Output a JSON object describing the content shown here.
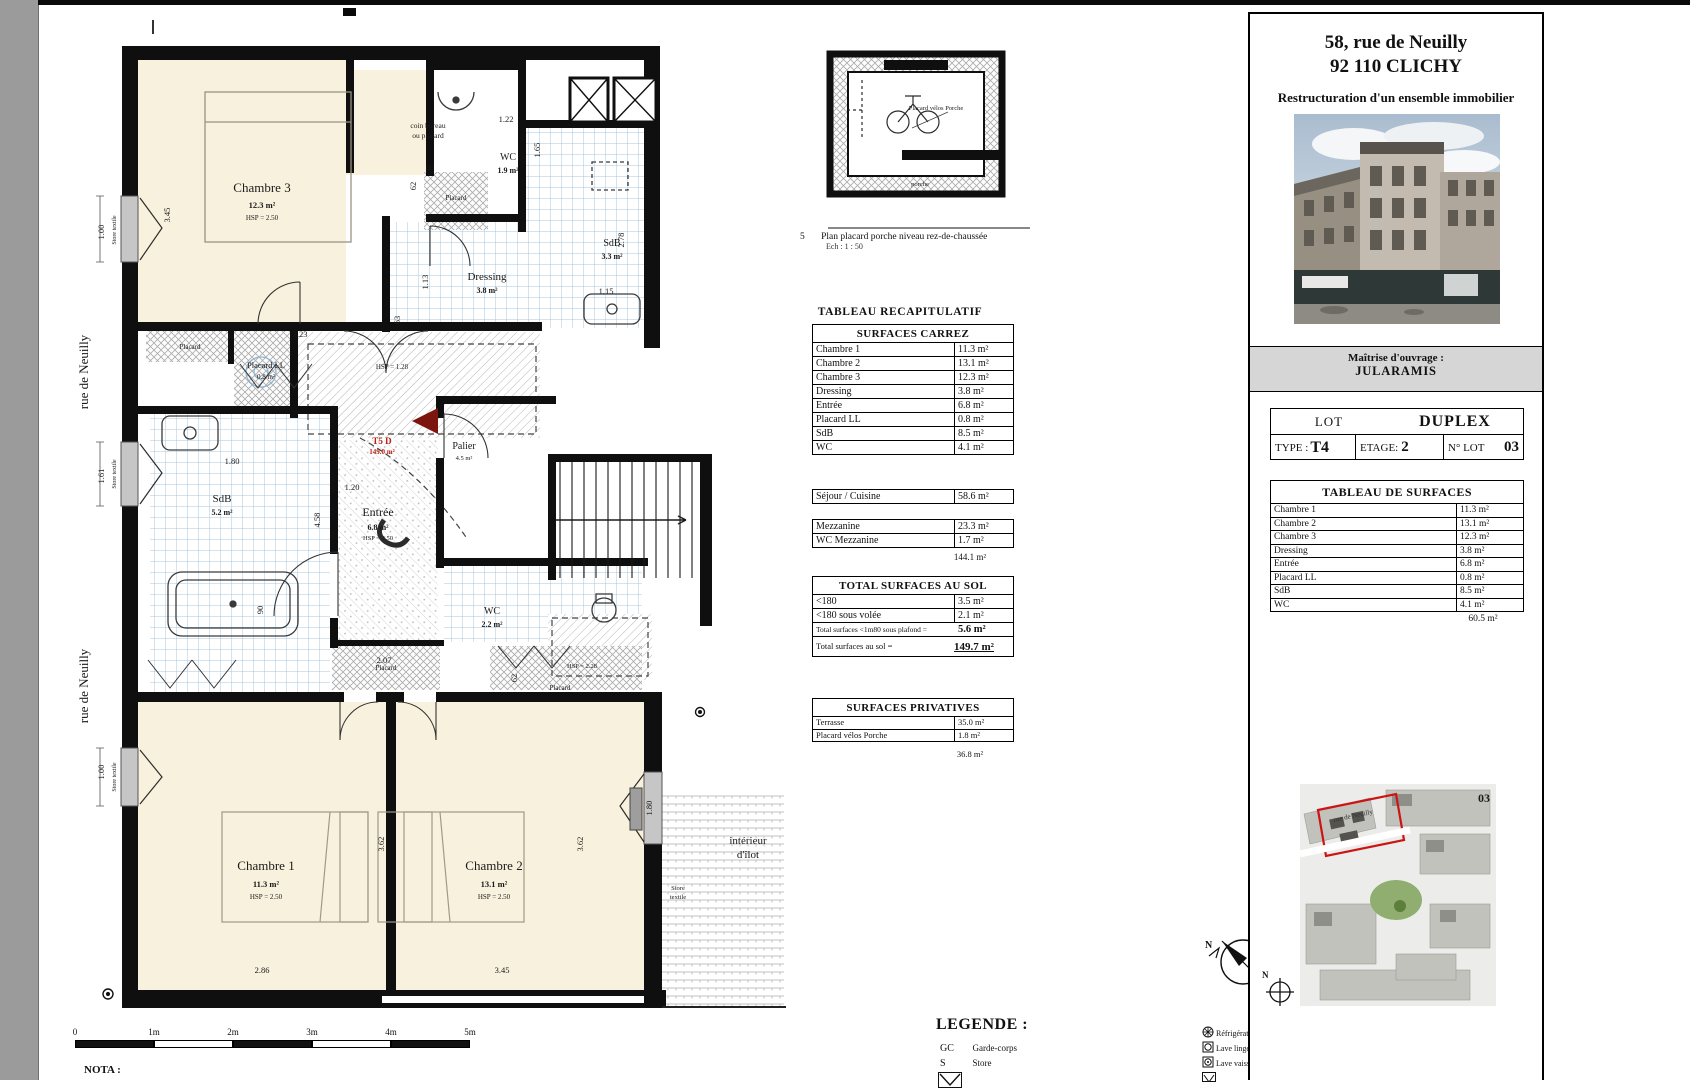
{
  "sheet": {
    "nota": "NOTA :"
  },
  "streets": {
    "rue": "rue de Neuilly"
  },
  "scalebar": {
    "labels": [
      "0",
      "1m",
      "2m",
      "3m",
      "4m",
      "5m"
    ]
  },
  "plan": {
    "chambre3": {
      "name": "Chambre 3",
      "area": "12.3 m²",
      "hsp": "HSP = 2.50"
    },
    "coin1": "coin bureau",
    "coin2": "ou placard",
    "wc_top": {
      "name": "WC",
      "area": "1.9 m²"
    },
    "sdb_top": {
      "name": "SdB",
      "area": "3.3 m²"
    },
    "dressing": {
      "name": "Dressing",
      "area": "3.8 m²"
    },
    "placard": "Placard",
    "placard_ll": {
      "name": "Placard LL",
      "area": "0.8 m²"
    },
    "hsp_128": "HSP = 1.28",
    "hsp_228": "HSP = 2.28",
    "lot_flag": {
      "name": "T5 D",
      "area": "149.0 m²"
    },
    "palier": {
      "name": "Palier",
      "area": "4.5 m²"
    },
    "entree": {
      "name": "Entrée",
      "area": "6.8 m²",
      "hsp": "HSP = 2.50"
    },
    "sdb_main": {
      "name": "SdB",
      "area": "5.2 m²"
    },
    "wc_mid": {
      "name": "WC",
      "area": "2.2 m²"
    },
    "chambre1": {
      "name": "Chambre 1",
      "area": "11.3 m²",
      "hsp": "HSP = 2.50"
    },
    "chambre2": {
      "name": "Chambre 2",
      "area": "13.1 m²",
      "hsp": "HSP = 2.50"
    },
    "interieur1": "intérieur",
    "interieur2": "d'îlot",
    "store": "Store textile",
    "store1": "Store",
    "store2": "textile",
    "dims": {
      "v345": "3.45",
      "h323": "3.23",
      "h60": "60",
      "h122": "1.22",
      "v165": "1.65",
      "v278": "2.78",
      "v113": "1.13",
      "h115": "1.15",
      "v62": "62",
      "v63": "63",
      "h180": "1.80",
      "h120": "1.20",
      "v458": "4.58",
      "v90": "90",
      "h207": "2.07",
      "v362": "3.62",
      "v180": "1.80",
      "h286": "2.86",
      "h345": "3.45",
      "v100": "1.00",
      "v161": "1.61"
    }
  },
  "small_plan": {
    "num": "5",
    "caption": "Plan placard porche niveau rez-de-chaussée",
    "scale": "Ech : 1 : 50",
    "label": "Placard vélos Porche",
    "porche": "porche"
  },
  "recap": {
    "title": "TABLEAU RECAPITULATIF",
    "carrez_title": "SURFACES CARREZ",
    "carrez_rows": [
      {
        "label": "Chambre 1",
        "value": "11.3 m²"
      },
      {
        "label": "Chambre 2",
        "value": "13.1 m²"
      },
      {
        "label": "Chambre 3",
        "value": "12.3 m²"
      },
      {
        "label": "Dressing",
        "value": "3.8 m²"
      },
      {
        "label": "Entrée",
        "value": "6.8 m²"
      },
      {
        "label": "Placard LL",
        "value": "0.8 m²"
      },
      {
        "label": "SdB",
        "value": "8.5 m²"
      },
      {
        "label": "WC",
        "value": "4.1 m²"
      }
    ],
    "sejour": {
      "label": "Séjour / Cuisine",
      "value": "58.6 m²"
    },
    "mezz_rows": [
      {
        "label": "Mezzanine",
        "value": "23.3 m²"
      },
      {
        "label": "WC Mezzanine",
        "value": "1.7 m²"
      }
    ],
    "mezz_total": "144.1 m²",
    "sol_title": "TOTAL SURFACES AU SOL",
    "sol_rows": [
      {
        "label": "<180",
        "value": "3.5 m²"
      },
      {
        "label": "<180 sous volée",
        "value": "2.1 m²"
      }
    ],
    "sol_sub_label": "Total surfaces <1m80 sous plafond =",
    "sol_sub_value": "5.6 m²",
    "sol_total_label": "Total surfaces au sol =",
    "sol_total_value": "149.7 m²",
    "priv_title": "SURFACES PRIVATIVES",
    "priv_rows": [
      {
        "label": "Terrasse",
        "value": "35.0 m²"
      },
      {
        "label": "Placard vélos Porche",
        "value": "1.8 m²"
      }
    ],
    "priv_total": "36.8 m²"
  },
  "legend": {
    "title": "LEGENDE :",
    "gc_abbr": "GC",
    "gc": "Garde-corps",
    "s_abbr": "S",
    "s": "Store",
    "appliances": [
      "Réfrigérateur",
      "Lave linge",
      "Lave vaisselle"
    ],
    "north": "N"
  },
  "panel": {
    "address1": "58, rue de Neuilly",
    "address2": "92 110 CLICHY",
    "subtitle": "Restructuration d'un ensemble immobilier",
    "moa_label": "Maîtrise d'ouvrage :",
    "moa": "JULARAMIS",
    "lot_label": "LOT",
    "lot_value": "DUPLEX",
    "type_label": "TYPE :",
    "type_value": "T4",
    "etage_label": "ETAGE:",
    "etage_value": "2",
    "nlot_label": "N° LOT",
    "nlot_value": "03",
    "surf_title": "TABLEAU DE SURFACES",
    "surf_rows": [
      {
        "label": "Chambre 1",
        "value": "11.3 m²"
      },
      {
        "label": "Chambre 2",
        "value": "13.1 m²"
      },
      {
        "label": "Chambre 3",
        "value": "12.3 m²"
      },
      {
        "label": "Dressing",
        "value": "3.8 m²"
      },
      {
        "label": "Entrée",
        "value": "6.8 m²"
      },
      {
        "label": "Placard LL",
        "value": "0.8 m²"
      },
      {
        "label": "SdB",
        "value": "8.5 m²"
      },
      {
        "label": "WC",
        "value": "4.1 m²"
      }
    ],
    "surf_total": "60.5 m²",
    "site_num": "03",
    "site_street": "rue de Neuilly",
    "north": "N"
  }
}
